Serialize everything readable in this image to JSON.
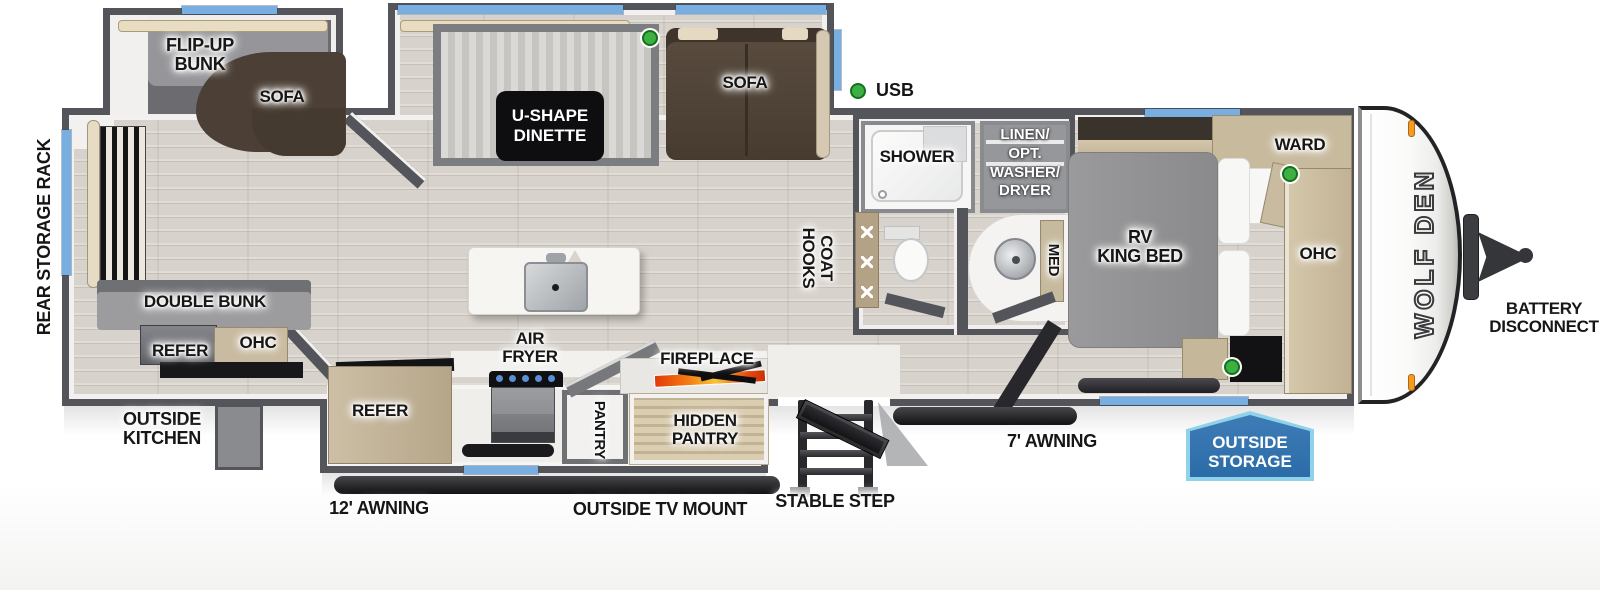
{
  "title": "WOLF DEN travel trailer floorplan",
  "labels": {
    "rear_storage_rack": "REAR STORAGE RACK",
    "flip_up_bunk": "FLIP-UP\nBUNK",
    "sofa_bunk_slide": "SOFA",
    "u_shape_dinette": "U-SHAPE\nDINETTE",
    "sofa_main": "SOFA",
    "usb": "USB",
    "double_bunk": "DOUBLE BUNK",
    "refer_rear": "REFER",
    "ohc_rear": "OHC",
    "outside_kitchen": "OUTSIDE\nKITCHEN",
    "air_fryer": "AIR\nFRYER",
    "refer_kitchen": "REFER",
    "pantry": "PANTRY",
    "hidden_pantry": "HIDDEN\nPANTRY",
    "fireplace": "FIREPLACE",
    "coat_hooks": "COAT HOOKS",
    "shower": "SHOWER",
    "linen_opt": "LINEN/\nOPT.\nWASHER/\nDRYER",
    "med": "MED",
    "rv_king_bed": "RV\nKING BED",
    "ward": "WARD",
    "ohc_bedroom": "OHC",
    "brand": "WOLF DEN",
    "battery_disconnect": "BATTERY\nDISCONNECT",
    "awning_12": "12' AWNING",
    "outside_tv_mount": "OUTSIDE TV MOUNT",
    "stable_step": "STABLE STEP",
    "awning_7": "7' AWNING",
    "outside_storage": "OUTSIDE\nSTORAGE"
  },
  "indicators": {
    "usb_ports": 4
  },
  "colors": {
    "wall": "#54555A",
    "floor": "#D7D2CB",
    "window": "#79AEE0",
    "usb_dot": "#3CB043",
    "sofa": "#4C4036",
    "badge_fill": "#2B6CA8",
    "badge_border": "#8FD2EA",
    "flame": "#F2600D",
    "clearance_light": "#F59A23"
  }
}
